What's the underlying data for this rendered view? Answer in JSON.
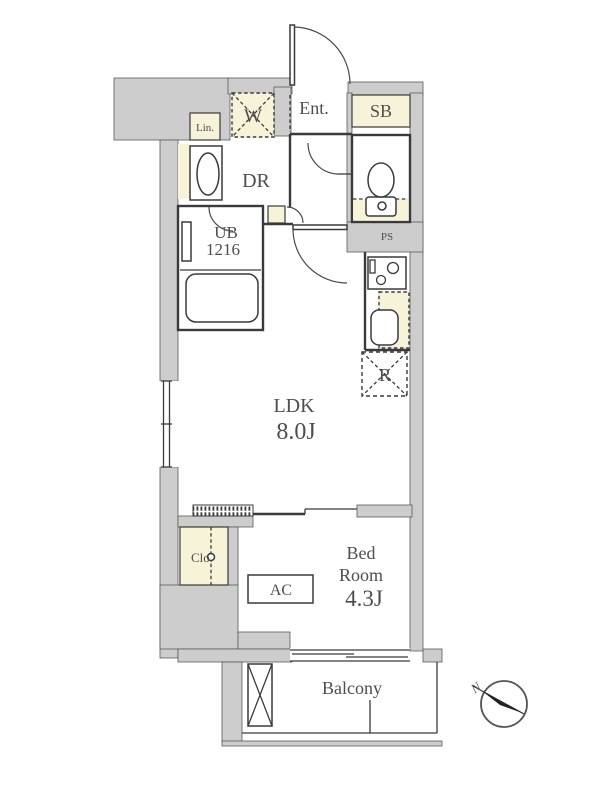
{
  "title": "Apartment floor plan",
  "colors": {
    "wall_gray": "#cdcdcd",
    "highlight_cream": "#f7f3d9",
    "line": "#3a3a3a",
    "text": "#4e4e4e",
    "background": "#ffffff"
  },
  "rooms": {
    "entrance": {
      "label": "Ent."
    },
    "shoe_box": {
      "label": "SB"
    },
    "washer_space": {
      "label": "W"
    },
    "linen": {
      "label": "Lin."
    },
    "dressing_room": {
      "label": "DR"
    },
    "unit_bath": {
      "label": "UB",
      "size": "1216"
    },
    "pipe_space": {
      "label": "PS"
    },
    "refrigerator_space": {
      "label": "R"
    },
    "ldk": {
      "label": "LDK",
      "area": "8.0J"
    },
    "closet": {
      "label": "Clo."
    },
    "air_conditioner": {
      "label": "AC"
    },
    "bedroom": {
      "label_line1": "Bed",
      "label_line2": "Room",
      "area": "4.3J"
    },
    "balcony": {
      "label": "Balcony"
    },
    "compass": {
      "north_label": "N"
    }
  }
}
